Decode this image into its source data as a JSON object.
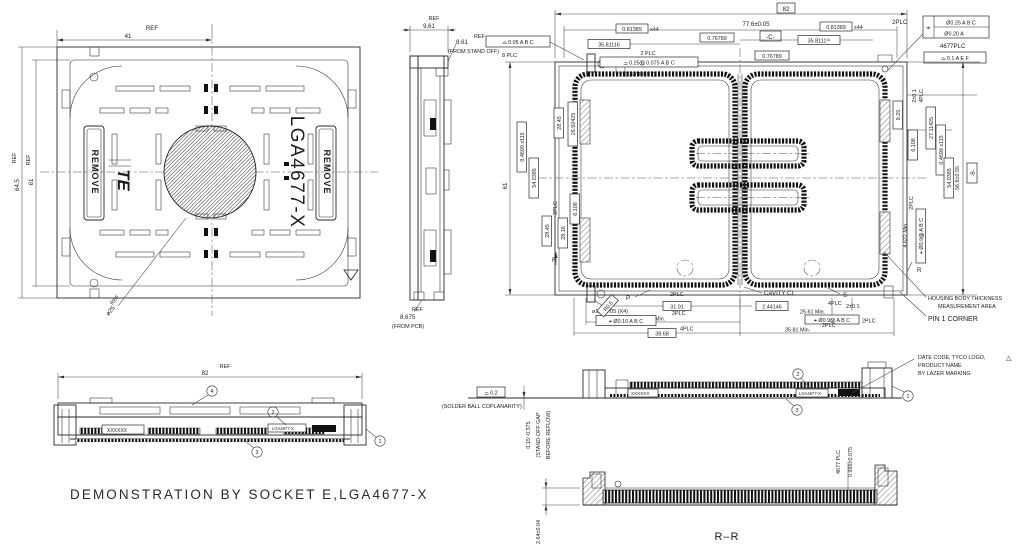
{
  "drawing": {
    "title": "DEMONSTRATION  BY  SOCKET  E,LGA4677-X"
  },
  "plan_view": {
    "dim_41": "41",
    "dim_41_ref": "REF",
    "dim_645": "64.5",
    "dim_645_ref": "REF",
    "dim_61": "61",
    "dim_61_ref": "REF",
    "remove_left": "REMOVE",
    "remove_right": "REMOVE",
    "product": "LGA4677-X",
    "logo": "TE",
    "circle_dia": "ø25",
    "circle_ref": "REF"
  },
  "side_view": {
    "dim_961": "9.61",
    "ref1": "REF",
    "dim_861": "8.61",
    "ref2": "REF",
    "note_standoff": "(FROM STAND OFF)",
    "dim_8675": "8.675",
    "ref3": "REF",
    "note_pcb": "(FROM PCB)"
  },
  "main_view": {
    "dim_82": "82",
    "plc2_top": "2PLC",
    "dim_776": "77.6±0.05",
    "datum_c": "-C-",
    "pitch_x_l": "0.81389",
    "pitch_x_l_count": "x44",
    "pitch_x_r": "0.81389",
    "pitch_x_r_count": "x44",
    "dim_3581116_l": "35.81116",
    "dim_3581116_r": "35.8111¹⁶",
    "dim_076789_a": "0.76789",
    "dim_076789_b": "0.76789",
    "keypost_plc": "2  PLC",
    "keypost_fcf": "⌓ 0.25Ⓜ 0.075 A B C",
    "keypost_note": "(KEY  POST)",
    "profile8_fcf": "⌓  0.05  A B C",
    "profile8_plc": "8  PLC",
    "pos_sym": "⌖",
    "pos_row1": "Ø0.25  A B C",
    "pos_row2": "Ø0.20  A",
    "pos_plc": "4677PLC",
    "aef_fcf": "⌓  0.1  A E F",
    "dim_925": "9.25",
    "dim_2401_r": "2±0.1",
    "lbl_4plc_r": "4PLC",
    "dim_2711425": "27.11425",
    "dim_6108_r": "6.108",
    "pitch_y_r": "0.4699 x115",
    "dim_540385_r": "54.0385",
    "dim_566": "56.6±0.05",
    "datum_b": "-B-",
    "dim_4622": "4.622  Min.",
    "plc2_r": "2PLC",
    "pos_fcf_r": "⌖ Ø0.9Ⓜ A B C",
    "dim_61": "61",
    "pitch_y_l": "0.4699 x115",
    "dim_540385_l": "54.0385",
    "dim_2845_t": "28.45",
    "dim_2692425": "26.92425",
    "plc2_l": "2PLC",
    "dim_2845_b": "28.45",
    "dim_2816": "28.16",
    "dim_6108_l": "6.108",
    "sec_r": "R",
    "sec_p": "P",
    "sec_s": "S",
    "dim_hole": "ø1.0±0.05  (X4)",
    "hole_fcf": "⌖ Ø0.10 A B C",
    "radius": "R0.5",
    "plc2_b1": "2PLC",
    "dim_3101": "31.01",
    "cavity": "CAVITY  CL",
    "dim_244146": "2.44146",
    "lbl_4plc_b": "4PLC",
    "dim_2401_b": "2±0.1",
    "dim_2561": "25.61  Min.",
    "pos_fcf_b": "⌖ Ø0.9Ⓜ A B C",
    "plc2_b2": "2PLC",
    "plc2_b3": "2PLC",
    "dim_3581_l": "35.81  Min.",
    "dim_3868": "38.68",
    "lbl_4plc_b2": "4PLC",
    "dim_3581_r": "35.81  Min.",
    "plc2_b4": "2PLC",
    "note_housing1": "HOUSING  BODY  THICKNESS",
    "note_housing2": "MEASUREMENT  AREA",
    "note_pin1": "PIN  1  CORNER"
  },
  "bottom_view": {
    "dim_82": "82",
    "ref": "REF",
    "balloon_1": "1",
    "balloon_2": "2",
    "balloon_3": "3",
    "balloon_4": "4",
    "marking": "XXXXXX",
    "product": "LGA4677-X"
  },
  "section_view": {
    "coplanarity_fcf": "⌓  0.2",
    "coplanarity_note": "(SOLDER  BALL  COPLANARITY)",
    "standoff_dim": "0.15~0.375",
    "standoff_note1": "(STAND-OFF  GAP",
    "standoff_note2": "BEFORE  REFLOW)",
    "marking": "XXXXXX",
    "product": "LGA4677-X",
    "balloon_1": "1",
    "balloon_2": "2",
    "balloon_3": "3",
    "note_line1": "DATE  CODE,  TYCO  LOGO,",
    "note_flag": "△",
    "note_line2": "PRODUCT  NAME",
    "note_line3": "BY  LAZER  MARKING"
  },
  "rr_section": {
    "dim_height": "2.64±0.04",
    "pin_count": "4677  PLC",
    "pin_dim": "0.995±0.075",
    "label": "R–R"
  }
}
